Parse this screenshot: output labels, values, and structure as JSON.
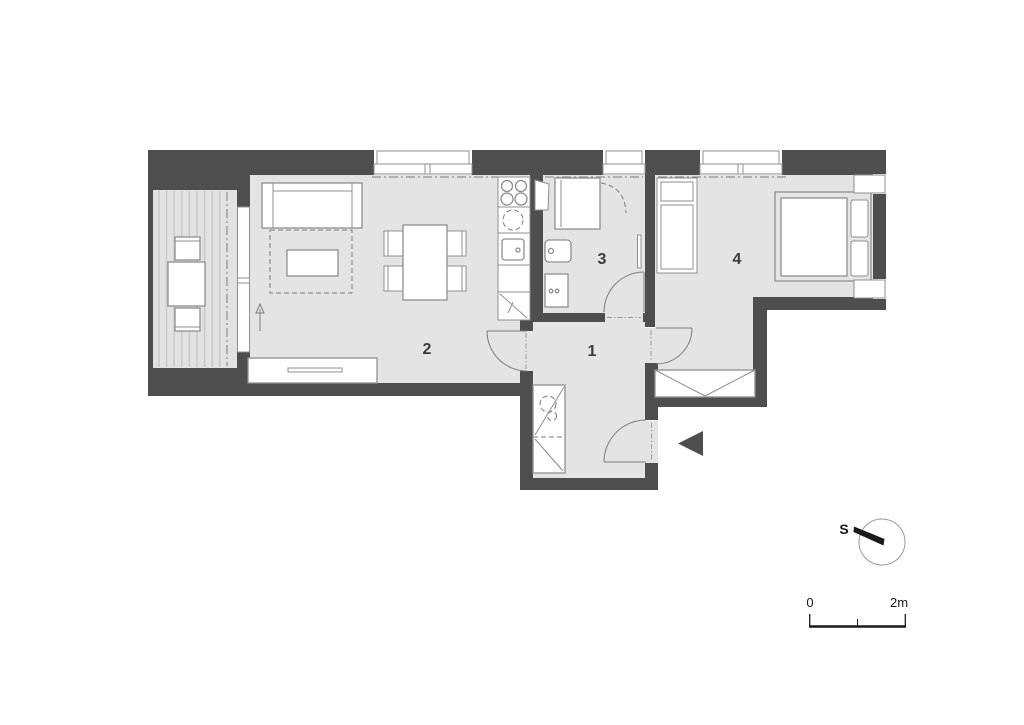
{
  "floor_plan": {
    "rooms": [
      {
        "number": "1",
        "name": "hall"
      },
      {
        "number": "2",
        "name": "living-room-kitchen"
      },
      {
        "number": "3",
        "name": "bathroom"
      },
      {
        "number": "4",
        "name": "bedroom"
      }
    ],
    "compass": {
      "label": "S"
    },
    "scale_bar": {
      "start": "0",
      "end": "2m"
    }
  },
  "colors": {
    "wall": "#4e4e4e",
    "floor": "#e4e4e4",
    "balcony_floor": "#e2e2e2",
    "balcony_stripe": "#c9c9c9",
    "furniture_stroke": "#8f8f8f",
    "line": "#7d7d7d",
    "label": "#3c3c3c",
    "ink": "#1a1a1a"
  }
}
